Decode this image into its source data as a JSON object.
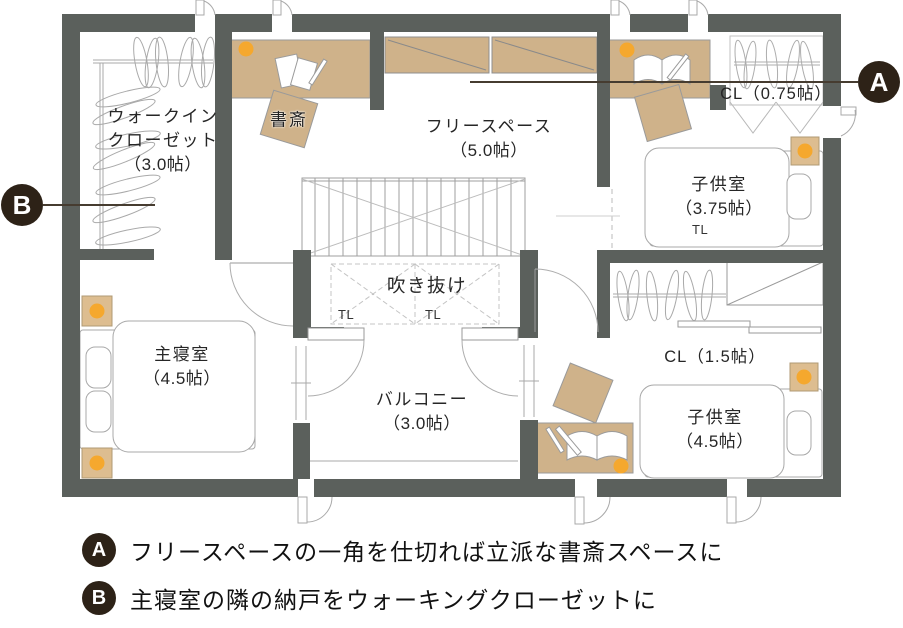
{
  "plan": {
    "markers": {
      "a": "A",
      "b": "B"
    },
    "rooms": {
      "walk_in_closet": {
        "line1": "ウォークイン",
        "line2": "クローゼット",
        "size": "（3.0帖）"
      },
      "study": {
        "label": "書斎"
      },
      "free_space": {
        "name": "フリースペース",
        "size": "（5.0帖）"
      },
      "closet_small": {
        "label": "CL（0.75帖）"
      },
      "kids_room_upper": {
        "name": "子供室",
        "size": "（3.75帖）",
        "toplight": "TL"
      },
      "atrium": {
        "name": "吹き抜け",
        "toplight_left": "TL",
        "toplight_right": "TL"
      },
      "master_bedroom": {
        "name": "主寝室",
        "size": "（4.5帖）"
      },
      "balcony": {
        "name": "バルコニー",
        "size": "（3.0帖）"
      },
      "closet_large": {
        "label": "CL（1.5帖）"
      },
      "kids_room_lower": {
        "name": "子供室",
        "size": "（4.5帖）"
      }
    },
    "colors": {
      "wall": "#5b605c",
      "furniture": "#cfb28a",
      "accent_dot": "#f5a82e",
      "badge": "#2d2217"
    }
  },
  "legend": {
    "items": [
      {
        "badge": "A",
        "text": "フリースペースの一角を仕切れば立派な書斎スペースに"
      },
      {
        "badge": "B",
        "text": "主寝室の隣の納戸をウォーキングクローゼットに"
      }
    ]
  }
}
